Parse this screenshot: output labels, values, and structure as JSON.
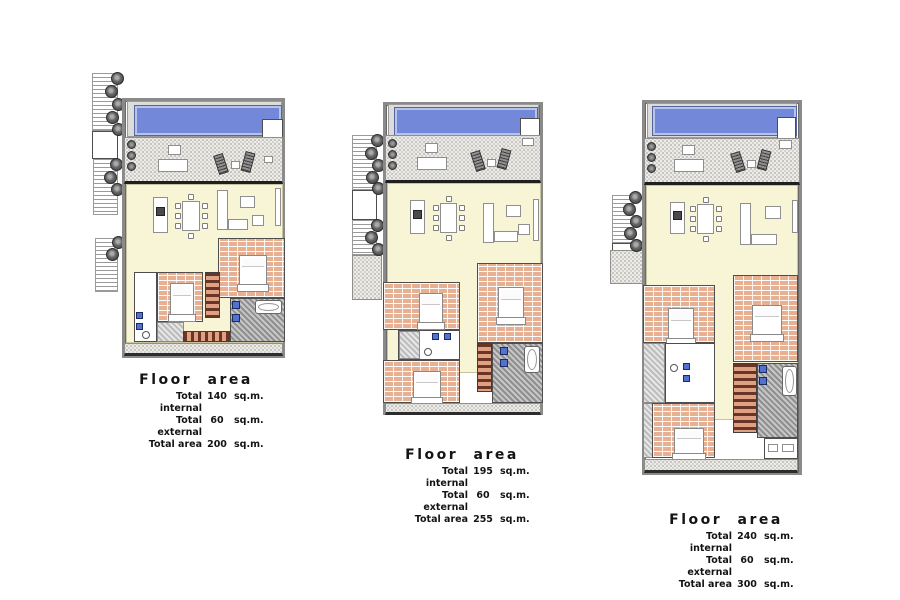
{
  "plans": [
    {
      "label": {
        "title": "Floor area",
        "rows": [
          {
            "label": "Total internal",
            "value": "140",
            "unit": "sq.m."
          },
          {
            "label": "Total external",
            "value": "60",
            "unit": "sq.m."
          },
          {
            "label": "Total area",
            "value": "200",
            "unit": "sq.m."
          }
        ]
      }
    },
    {
      "label": {
        "title": "Floor area",
        "rows": [
          {
            "label": "Total internal",
            "value": "195",
            "unit": "sq.m."
          },
          {
            "label": "Total external",
            "value": "60",
            "unit": "sq.m."
          },
          {
            "label": "Total area",
            "value": "255",
            "unit": "sq.m."
          }
        ]
      }
    },
    {
      "label": {
        "title": "Floor area",
        "rows": [
          {
            "label": "Total internal",
            "value": "240",
            "unit": "sq.m."
          },
          {
            "label": "Total external",
            "value": "60",
            "unit": "sq.m."
          },
          {
            "label": "Total area",
            "value": "300",
            "unit": "sq.m."
          }
        ]
      }
    }
  ],
  "colors": {
    "pool": "#7388d8",
    "pool_edge": "#b6c3ea",
    "terrace": "#edece8",
    "living": "#f8f5d6",
    "brick": "#e7b093",
    "bath_hatch": "#8f8f8f",
    "fixture_blue": "#5272d2",
    "tree": "#4c4c4c",
    "wall": "#2c2c2c"
  }
}
